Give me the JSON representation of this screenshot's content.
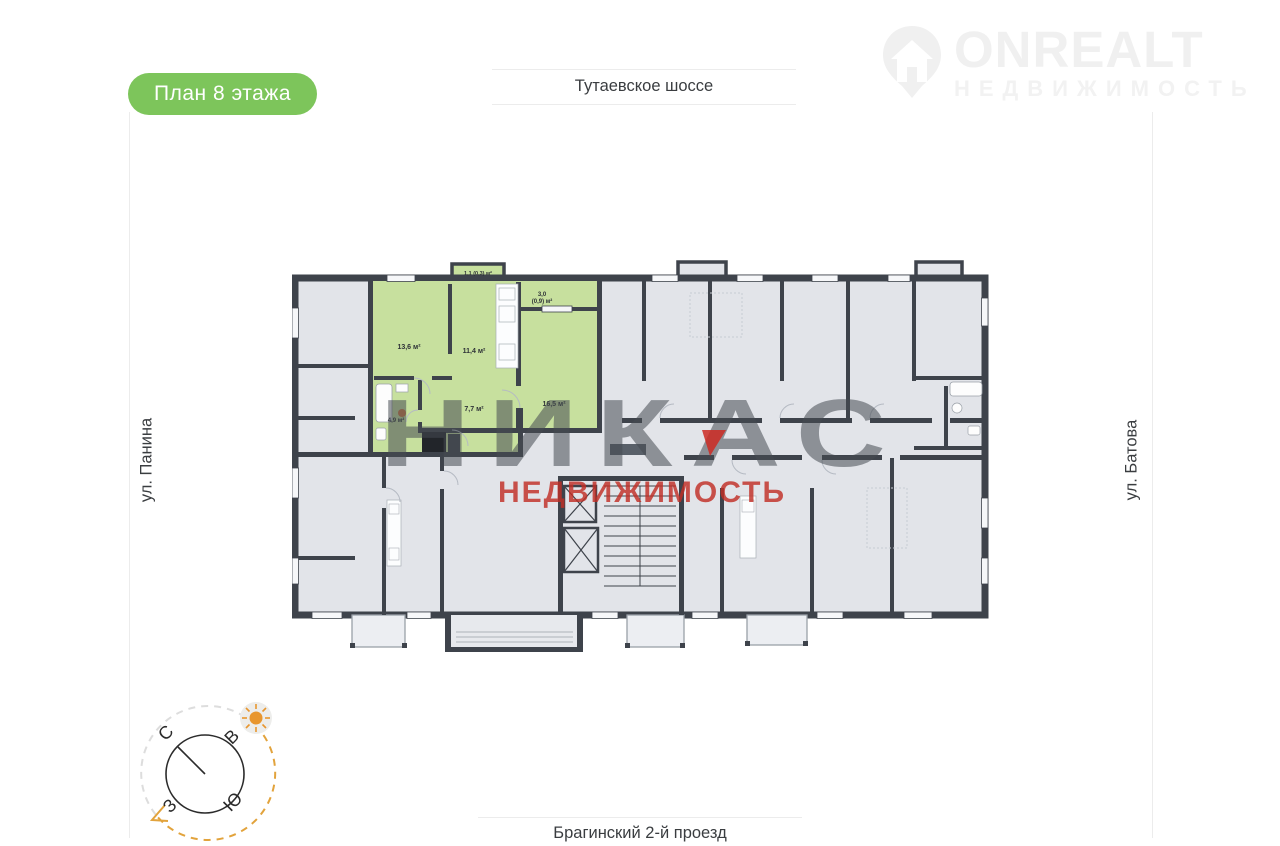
{
  "badge": {
    "label": "План 8 этажа",
    "color": "#7dc55b"
  },
  "streets": {
    "top": "Тутаевское шоссе",
    "bottom": "Брагинский 2-й проезд",
    "left": "ул. Панина",
    "right": "ул. Батова"
  },
  "logo": {
    "title": "ONREALT",
    "subtitle": "НЕДВИЖИМОСТЬ"
  },
  "watermark": {
    "title": "НИКАС",
    "subtitle": "НЕДВИЖИМОСТЬ"
  },
  "compass": {
    "north": "С",
    "east": "В",
    "west": "З",
    "south": "Ю"
  },
  "floor_plan": {
    "floor": "8",
    "colors": {
      "highlight": "#c7e09e",
      "rooms": "#e2e4e9",
      "walls": "#3e434b",
      "marker": "#d4703a"
    },
    "highlighted_apartment": {
      "rooms": [
        {
          "name": "room",
          "area": "13,6 м²"
        },
        {
          "name": "kitchen",
          "area": "11,4 м²"
        },
        {
          "name": "hallway",
          "area": "7,7 м²"
        },
        {
          "name": "living-room",
          "area": "16,5 м²"
        },
        {
          "name": "bathroom",
          "area": "4,9 м²"
        },
        {
          "name": "balcony",
          "area": "1,1 (0,3) м²"
        },
        {
          "name": "loggia",
          "area_line1": "3,0",
          "area_line2": "(0,9) м²"
        }
      ]
    }
  }
}
